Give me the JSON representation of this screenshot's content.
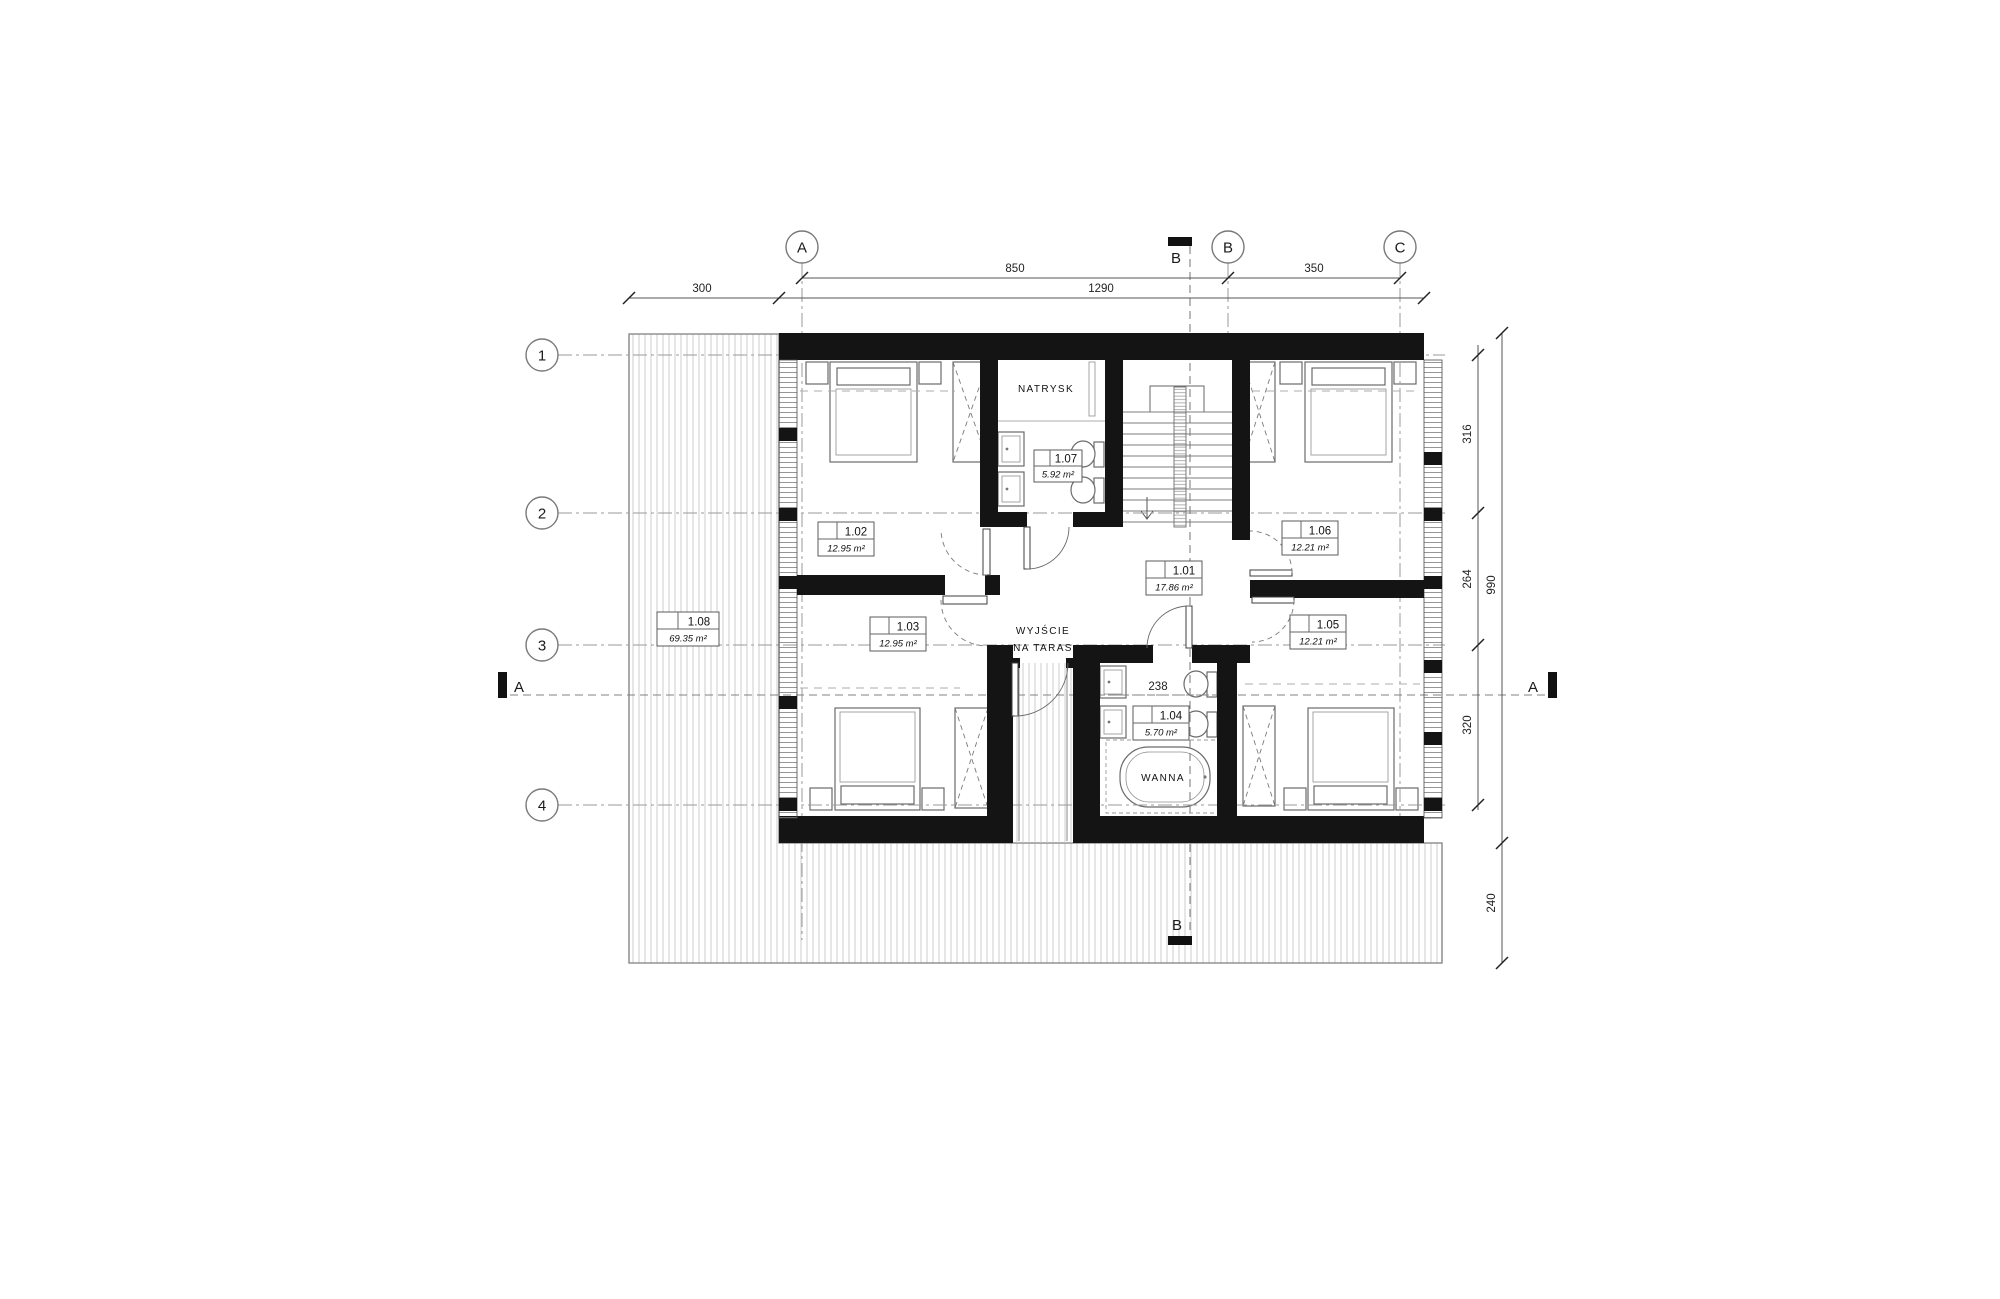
{
  "rooms": [
    {
      "number": "1.01",
      "area": "17.86 m²"
    },
    {
      "number": "1.02",
      "area": "12.95 m²"
    },
    {
      "number": "1.03",
      "area": "12.95 m²"
    },
    {
      "number": "1.04",
      "area": "5.70 m²"
    },
    {
      "number": "1.05",
      "area": "12.21 m²"
    },
    {
      "number": "1.06",
      "area": "12.21 m²"
    },
    {
      "number": "1.07",
      "area": "5.92 m²"
    },
    {
      "number": "1.08",
      "area": "69.35 m²"
    }
  ],
  "annotations": {
    "shower": "NATRYSK",
    "exit_line1": "WYJŚCIE",
    "exit_line2": "NA TARAS",
    "bathtub": "WANNA"
  },
  "grid": {
    "columns": [
      "A",
      "B",
      "C"
    ],
    "rows": [
      "1",
      "2",
      "3",
      "4"
    ]
  },
  "sections": {
    "a": "A",
    "b": "B"
  },
  "dimensions": {
    "top_850": "850",
    "top_350": "350",
    "top_300": "300",
    "top_1290": "1290",
    "right_316": "316",
    "right_264": "264",
    "right_320": "320",
    "right_990": "990",
    "right_240": "240",
    "interior_238": "238"
  },
  "colors": {
    "wall": "#141414",
    "line": "#555555",
    "hatch": "#c9c9c9",
    "background": "#ffffff"
  }
}
